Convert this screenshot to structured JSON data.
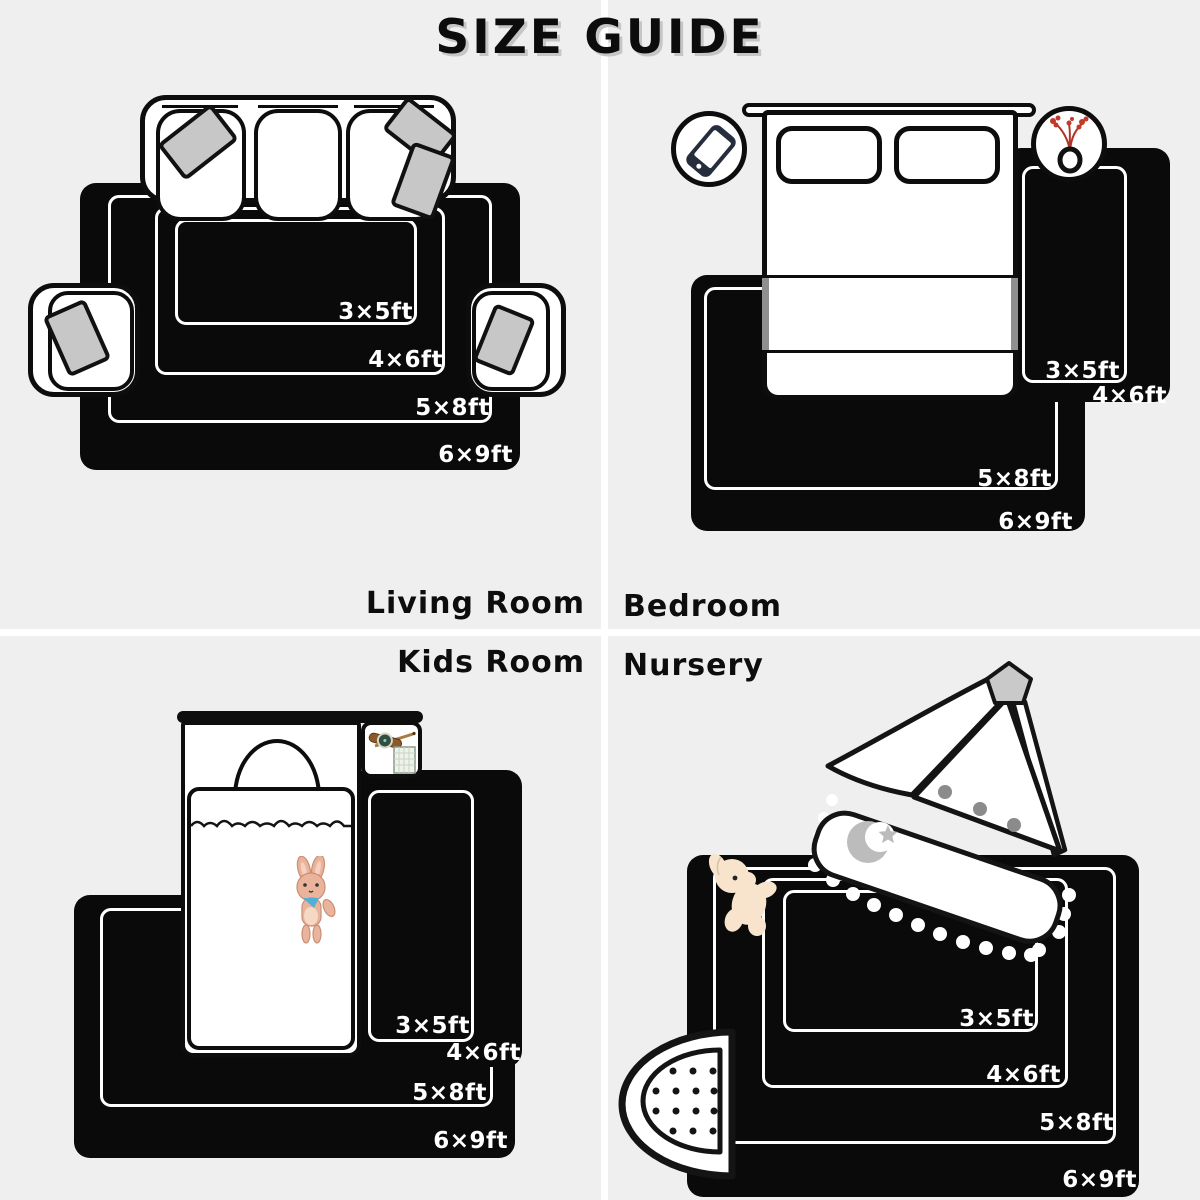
{
  "title": "SIZE GUIDE",
  "quadrants": [
    {
      "id": "living-room",
      "label": "Living Room",
      "sizes": {
        "s35": "3×5ft",
        "s46": "4×6ft",
        "s58": "5×8ft",
        "s69": "6×9ft"
      }
    },
    {
      "id": "bedroom",
      "label": "Bedroom",
      "sizes": {
        "s35": "3×5ft",
        "s46": "4×6ft",
        "s58": "5×8ft",
        "s69": "6×9ft"
      }
    },
    {
      "id": "kids-room",
      "label": "Kids Room",
      "sizes": {
        "s35": "3×5ft",
        "s46": "4×6ft",
        "s58": "5×8ft",
        "s69": "6×9ft"
      }
    },
    {
      "id": "nursery",
      "label": "Nursery",
      "sizes": {
        "s35": "3×5ft",
        "s46": "4×6ft",
        "s58": "5×8ft",
        "s69": "6×9ft"
      }
    }
  ],
  "icons": {
    "living_room": [
      "sofa",
      "armchair",
      "throw-pillow"
    ],
    "bedroom_left_circle": "phone-icon",
    "bedroom_right_circle": "vase-flowers-icon",
    "kids_room": [
      "bunny-plush-icon",
      "watch-icon",
      "pencil-icon",
      "notepad-icon"
    ],
    "nursery": [
      "teddy-plush-icon",
      "crescent-moon-icon",
      "star-icon",
      "pom-pom-trim",
      "polka-dot-mat",
      "canopy-finial"
    ]
  },
  "colors": {
    "background": "#efefef",
    "divider": "#ffffff",
    "rug_black": "#0a0a0a",
    "size_label_white": "#ffffff",
    "text_black": "#0d0d0d",
    "pillow_gray": "#c7c7c7",
    "blanket_edge_gray": "#8f8f8f",
    "flower_red": "#c0392b",
    "scarf_blue": "#55aed3",
    "plush_cream": "#f8e4cd",
    "bunny_tan": "#e7ae93",
    "canopy_dot_gray": "#8b8b8b",
    "moon_gray": "#bcbcbc"
  }
}
